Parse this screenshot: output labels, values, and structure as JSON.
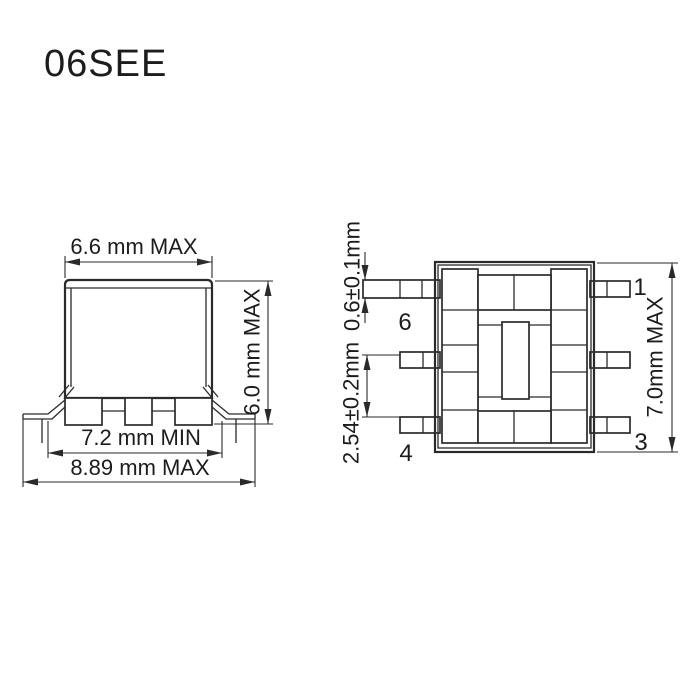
{
  "title": "06SEE",
  "colors": {
    "line": "#2a2a2a",
    "text": "#1c1c1c",
    "background": "#ffffff"
  },
  "side_view": {
    "dims": {
      "body_width": "6.6 mm MAX",
      "body_height": "6.0 mm MAX",
      "lead_span_min": "7.2 mm MIN",
      "overall_width": "8.89 mm MAX"
    }
  },
  "top_view": {
    "dims": {
      "lead_width": "0.6±0.1mm",
      "lead_pitch": "2.54±0.2mm",
      "body_length": "7.0mm MAX"
    },
    "pins": {
      "pin1": "1",
      "pin3": "3",
      "pin4": "4",
      "pin6": "6"
    }
  }
}
